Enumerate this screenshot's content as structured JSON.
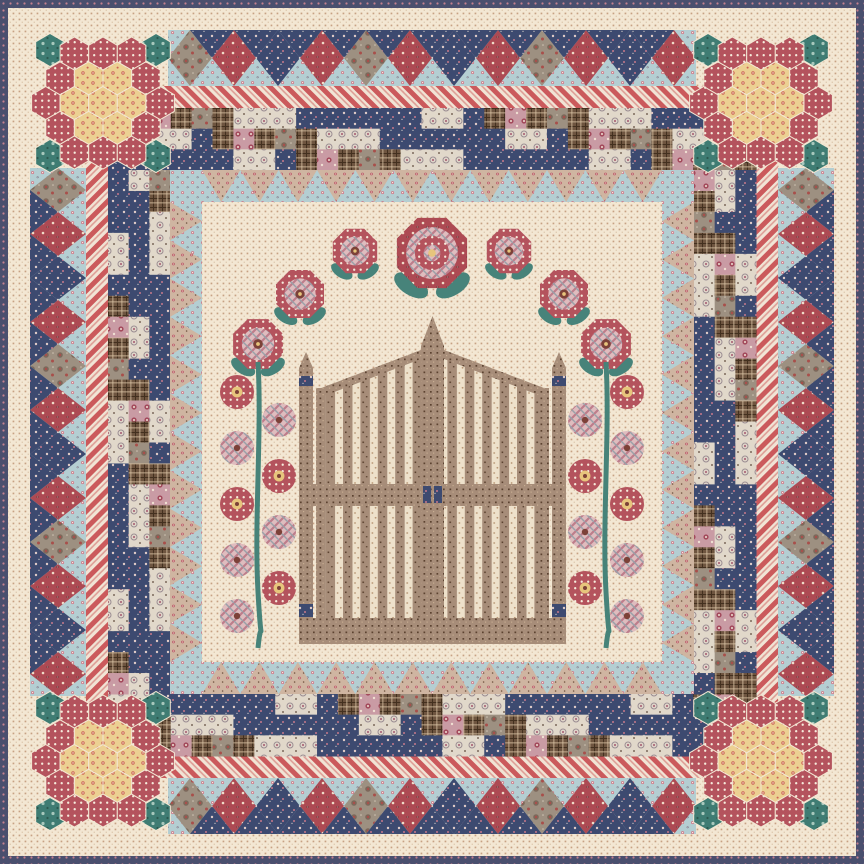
{
  "meta": {
    "title": "Patchwork quilt: garden gate with hollyhocks, rose arch, hexagon-rosette corners and pieced borders",
    "alt_text": "Square quilt with cream dotted background, navy binding, diamond border, red striped border, checkerboard border, blue dogtooth border, central taupe picket garden gate flanked by hollyhock stems under an arch of roses, and hexagon flower medallions in each corner"
  },
  "palette": {
    "cream_bg": "#f3e7d3",
    "cream_dot": "#c7a183",
    "cream_dot2": "#e0ccb2",
    "binding_bg": "#4a4f6e",
    "binding_dot": "#c4818f",
    "blue_bg": "#b4ced2",
    "blue_flower": "#cf7787",
    "blue_flower2": "#fdf6ea",
    "blue_spot": "#6e6a80",
    "tan_bg": "#cfb5a1",
    "tan_flower": "#bc5e6b",
    "tan_speck": "#6f523f",
    "stripe_red": "#cb5a5c",
    "stripe_cream": "#f1e4d5",
    "stripe_mid": "#dd9a93",
    "navy_bg": "#3d4a70",
    "navy_dot": "#e8e0d6",
    "navy_pink": "#c6788b",
    "creamfloral_bg": "#e1d8ca",
    "creamfloral_ring": "#9a8c92",
    "creamfloral_dot": "#ad6b7c",
    "browncheck_bg": "#6e5540",
    "browncheck_line": "#43301f",
    "browncheck_lite": "#d9c3a4",
    "pinkfloral_bg": "#c99ba4",
    "pinkfloral_rose": "#a34a5c",
    "pinkfloral_dot": "#f0dfd2",
    "taupe_bg": "#9d9081",
    "taupe_motif": "#7c695b",
    "taupe_red": "#a84f4b",
    "taupe_lite": "#cfc3b2",
    "redfloral_bg": "#ad4a53",
    "redfloral_dot": "#f0ddc8",
    "redfloral_dark": "#5f2832",
    "gate_bg": "#a78d79",
    "gate_speck": "#5c4331",
    "gate_lite": "#c7ad92",
    "slatgap_bg": "#eee1cb",
    "slatgap_dot": "#b89573",
    "plaid_bg": "#dfbcbe",
    "plaid_line1": "#bd7d8b",
    "plaid_line2": "#9aa0a8",
    "reddot_bg": "#b4535d",
    "reddot_dot": "#f6ecdc",
    "pinkdot_bg": "#d08e97",
    "pinkdot_dot": "#f6ecdc",
    "rose_center_brown": "#7c4138",
    "rose_yellow": "#e7c57c",
    "leaf_teal": "#47837a",
    "stem_teal": "#478379",
    "hexyellow_bg": "#ecd092",
    "hexyellow_motif": "#cb6355",
    "hexyellow_dot": "#f7ecd4",
    "hexteal_bg": "#3f7c73",
    "hexteal_motif": "#a8c8bd",
    "hexteal_dark": "#2b584f"
  },
  "layout": {
    "size": 864,
    "binding_width": 8,
    "diamond_band": {
      "start": 30,
      "end": 86,
      "from": 168,
      "to": 696,
      "cells": 12
    },
    "stripe_band": {
      "start": 86,
      "end": 108,
      "from": 108,
      "to": 756
    },
    "checker_band": {
      "start": 108,
      "end": 170,
      "from": 108,
      "to": 756,
      "rows": 3,
      "cols": 31,
      "side_rows": 25
    },
    "dogtooth_band": {
      "outer": 170,
      "inner": 202,
      "teeth": 12
    },
    "center": {
      "from": 202,
      "to": 662
    }
  },
  "diamond_cycle": [
    "taupePaisley",
    "redFloral",
    "navy",
    "redFloral"
  ],
  "checker_fabrics": [
    "navy",
    "creamFloral",
    "brownCheck",
    "pinkFloral",
    "taupePaisley"
  ],
  "checker_cycle": [
    0,
    1,
    0,
    2,
    1,
    0,
    3,
    1,
    0,
    2,
    0,
    1,
    4,
    0,
    1,
    2,
    0
  ],
  "rosettes": {
    "hex_size": 16.5,
    "centers": [
      [
        103,
        103
      ],
      [
        761,
        103
      ],
      [
        103,
        761
      ],
      [
        761,
        761
      ]
    ],
    "teal_offsets": [
      [
        -53,
        -53
      ],
      [
        53,
        -53
      ],
      [
        -53,
        53
      ],
      [
        53,
        53
      ]
    ],
    "ring_colors": {
      "inner": "yellowHex",
      "ring": "redDot",
      "corner": "teal"
    }
  },
  "gate": {
    "post_left_x": 299,
    "post_right_x": 552,
    "post_w": 14,
    "post_top": 368,
    "post_apex_y": 352,
    "navy_band_y": 376,
    "navy_band_h": 10,
    "door_left": 316,
    "door_right": 549,
    "door_outer_top": 390,
    "door_inner_top": 350,
    "center_left": 421,
    "center_right": 444,
    "peak_y": 316,
    "shoulder_y": 346,
    "mid_rail_y": 484,
    "mid_rail_h": 22,
    "bottom_rail_y": 618,
    "bottom_rail_h": 26,
    "gate_bottom": 644,
    "latch": [
      [
        423,
        486,
        8,
        17
      ],
      [
        434,
        486,
        8,
        17
      ]
    ],
    "feet": [
      [
        299,
        604,
        14,
        13
      ],
      [
        552,
        604,
        14,
        13
      ]
    ],
    "slat_period": 17.4,
    "slat_width": 9.6
  },
  "roses": [
    {
      "x": 432,
      "y": 253,
      "r": 38,
      "type": "grand",
      "leaves": true
    },
    {
      "x": 355,
      "y": 251,
      "r": 24,
      "type": "ring",
      "leaves": true
    },
    {
      "x": 509,
      "y": 251,
      "r": 24,
      "type": "ring",
      "leaves": true
    },
    {
      "x": 300,
      "y": 294,
      "r": 26,
      "type": "ring",
      "leaves": true
    },
    {
      "x": 564,
      "y": 294,
      "r": 26,
      "type": "ring",
      "leaves": true
    },
    {
      "x": 258,
      "y": 344,
      "r": 27,
      "type": "ring",
      "leaves": true
    },
    {
      "x": 606,
      "y": 344,
      "r": 27,
      "type": "ring",
      "leaves": true
    }
  ],
  "hollyhocks": {
    "stem_top": 362,
    "stem_bottom": 648,
    "stem_width": 5,
    "bloom_r": 17,
    "bloom_offset": 21,
    "stems": [
      {
        "x": 258,
        "blooms": [
          {
            "y": 392,
            "side": -1,
            "type": "ring"
          },
          {
            "y": 420,
            "side": 1,
            "type": "plaid"
          },
          {
            "y": 448,
            "side": -1,
            "type": "plaid"
          },
          {
            "y": 476,
            "side": 1,
            "type": "ring"
          },
          {
            "y": 504,
            "side": -1,
            "type": "ring"
          },
          {
            "y": 532,
            "side": 1,
            "type": "plaid"
          },
          {
            "y": 560,
            "side": -1,
            "type": "plaid"
          },
          {
            "y": 588,
            "side": 1,
            "type": "ring"
          },
          {
            "y": 616,
            "side": -1,
            "type": "plaid"
          }
        ]
      },
      {
        "x": 606,
        "blooms": [
          {
            "y": 392,
            "side": 1,
            "type": "ring"
          },
          {
            "y": 420,
            "side": -1,
            "type": "plaid"
          },
          {
            "y": 448,
            "side": 1,
            "type": "plaid"
          },
          {
            "y": 476,
            "side": -1,
            "type": "ring"
          },
          {
            "y": 504,
            "side": 1,
            "type": "ring"
          },
          {
            "y": 532,
            "side": -1,
            "type": "plaid"
          },
          {
            "y": 560,
            "side": 1,
            "type": "plaid"
          },
          {
            "y": 588,
            "side": -1,
            "type": "ring"
          },
          {
            "y": 616,
            "side": 1,
            "type": "plaid"
          }
        ]
      }
    ]
  }
}
